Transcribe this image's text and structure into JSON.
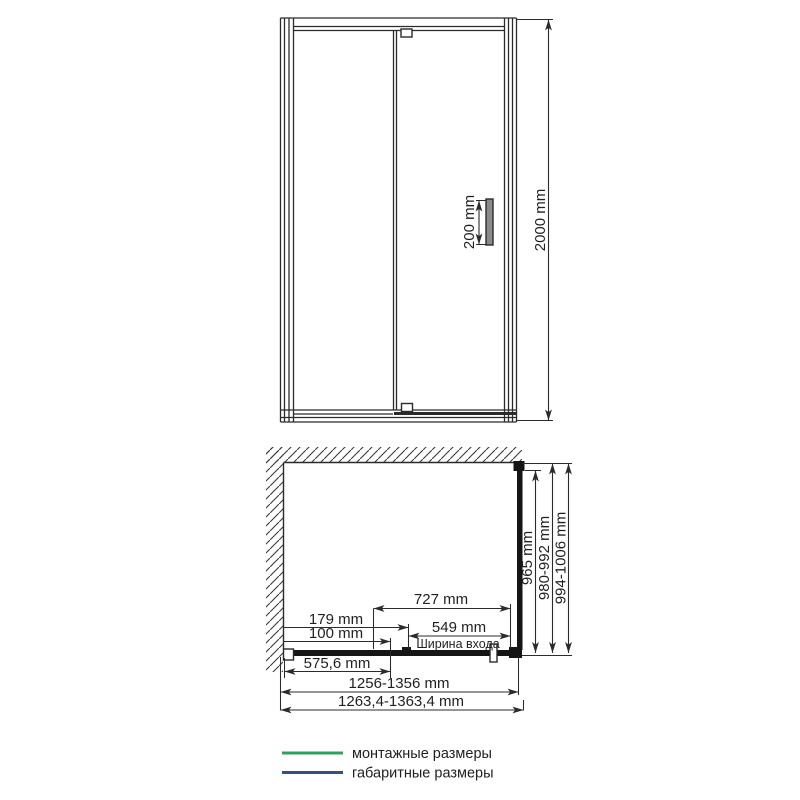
{
  "front_view": {
    "handle_height": "200 mm",
    "door_height": "2000 mm"
  },
  "plan_view": {
    "dim_727": "727 mm",
    "dim_179": "179 mm",
    "dim_100": "100 mm",
    "dim_549": "549 mm",
    "entry_width_label": "Ширина входа",
    "dim_575": "575,6 mm",
    "dim_965": "965 mm",
    "mounting_depth": "980-992 mm",
    "overall_depth": "994-1006 mm",
    "mounting_width": "1256-1356 mm",
    "overall_width": "1263,4-1363,4 mm"
  },
  "legend": {
    "mounting_label": "монтажные размеры",
    "overall_label": "габаритные размеры"
  },
  "colors": {
    "line": "#2b2b2b",
    "mounting_green": "#2fa05e",
    "overall_navy": "#31517e",
    "muted_text": "#9a9a9a",
    "legend_text": "#5b6572"
  }
}
